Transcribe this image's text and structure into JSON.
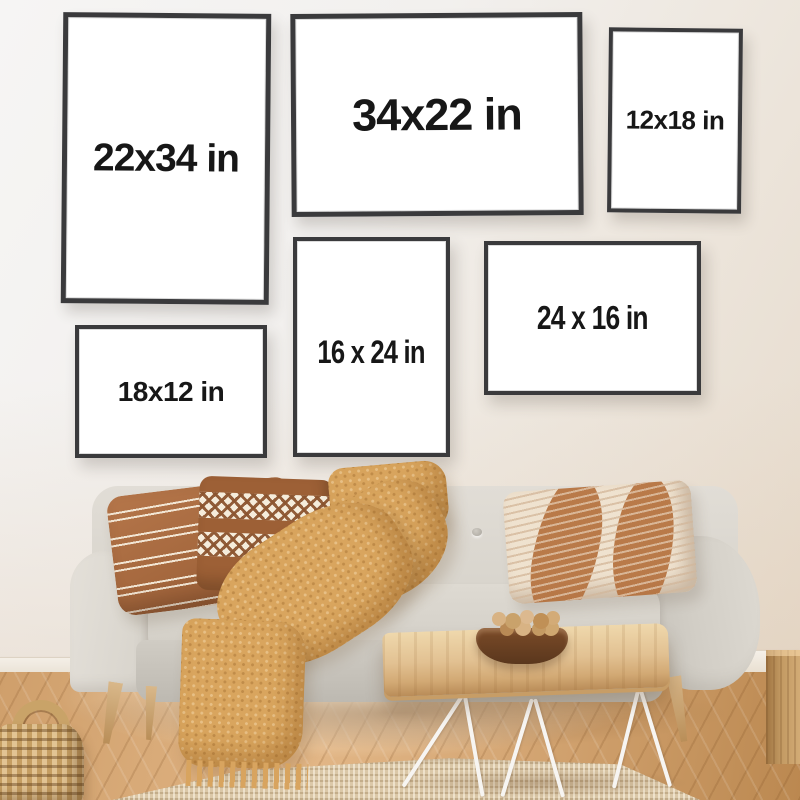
{
  "frames": [
    {
      "id": "frame-1",
      "label": "22x34 in",
      "orientation": "portrait"
    },
    {
      "id": "frame-2",
      "label": "34x22 in",
      "orientation": "landscape"
    },
    {
      "id": "frame-3",
      "label": "12x18 in",
      "orientation": "portrait"
    },
    {
      "id": "frame-4",
      "label": "16 x 24 in",
      "orientation": "portrait"
    },
    {
      "id": "frame-5",
      "label": "24 x 16 in",
      "orientation": "landscape"
    },
    {
      "id": "frame-6",
      "label": "18x12 in",
      "orientation": "landscape"
    }
  ],
  "colors": {
    "wall": "#f2f0ee",
    "wall_warm": "#e6dacb",
    "frame_border": "#3a3a3c",
    "frame_mat": "#ffffff",
    "label_text": "#171717",
    "sofa_fabric": "#d8d4cc",
    "pillow_rust": "#a5683e",
    "pillow_cream": "#f3e8d7",
    "blanket_mustard": "#d9a55e",
    "floor_wood": "#d6a876",
    "table_wood": "#e2c192",
    "table_leg_white": "#f7f5f2",
    "bowl_walnut": "#6e4526",
    "rug_jute": "#dbc8a8",
    "basket_rattan": "#c59e62",
    "cube_wood": "#c39a63"
  }
}
